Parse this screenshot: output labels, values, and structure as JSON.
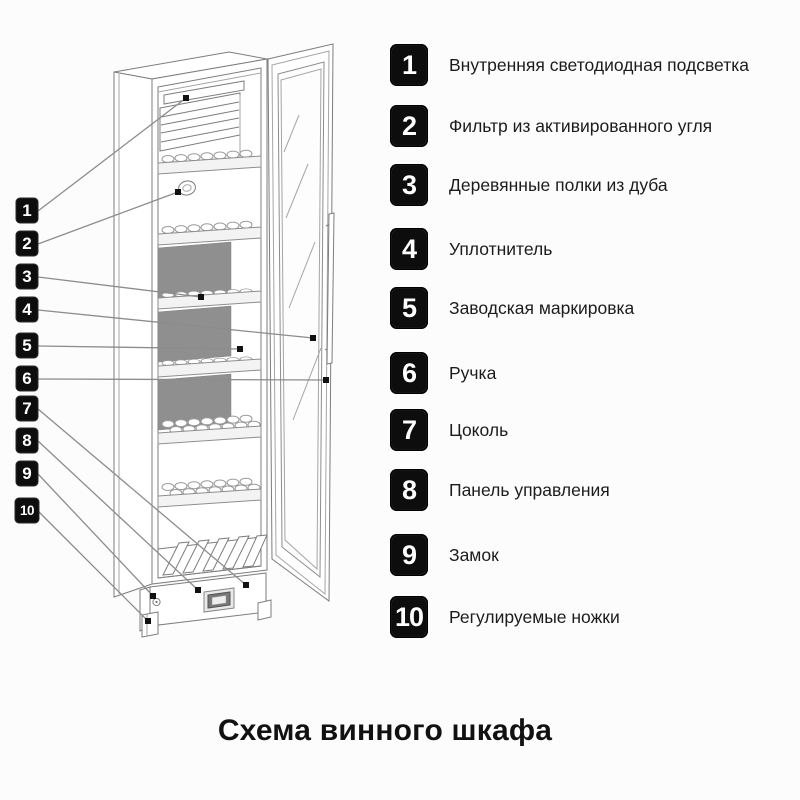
{
  "title": "Схема винного шкафа",
  "legend": {
    "items": [
      {
        "num": "1",
        "label": "Внутренняя светодиодная подсветка"
      },
      {
        "num": "2",
        "label": "Фильтр из активированного угля"
      },
      {
        "num": "3",
        "label": "Деревянные полки из дуба"
      },
      {
        "num": "4",
        "label": "Уплотнитель"
      },
      {
        "num": "5",
        "label": "Заводская маркировка"
      },
      {
        "num": "6",
        "label": "Ручка"
      },
      {
        "num": "7",
        "label": "Цоколь"
      },
      {
        "num": "8",
        "label": "Панель управления"
      },
      {
        "num": "9",
        "label": "Замок"
      },
      {
        "num": "10",
        "label": "Регулируемые ножки"
      }
    ]
  },
  "colors": {
    "badge_bg": "#0d0d0d",
    "badge_text": "#ffffff",
    "outline_gray": "#7d7d7d",
    "leader_gray": "#8c8c8c",
    "back_panel_gray": "#8f8f8f",
    "text": "#1c1c1c",
    "background": "#fcfcfc"
  }
}
